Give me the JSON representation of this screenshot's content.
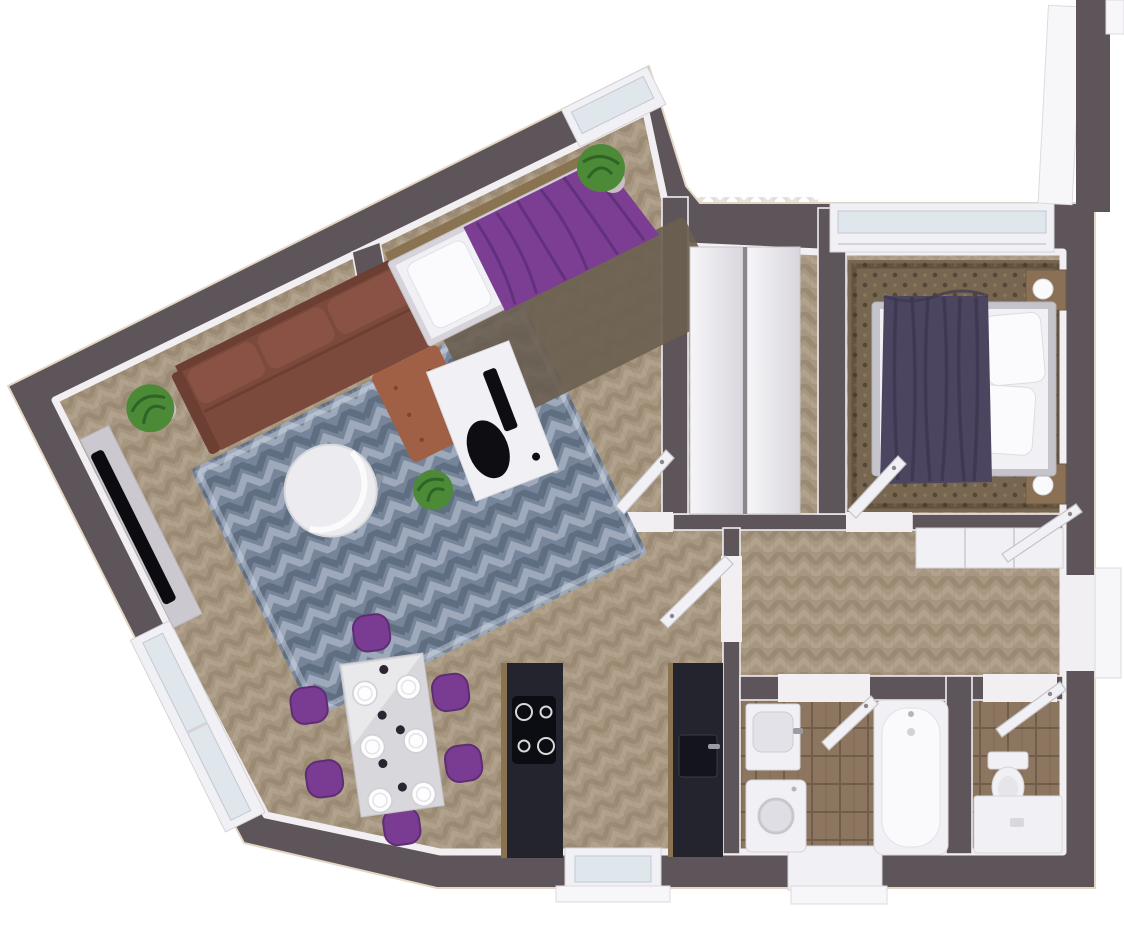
{
  "meta": {
    "title": "3D top-view render of an apartment floor plan",
    "view": "top-down 3D render",
    "visible_text": "none"
  },
  "colors": {
    "background": "#ffffff",
    "wall": "#5e555b",
    "trim": "#f1eff2",
    "wood_floor": "#a89780",
    "tile_floor": "#8d7660",
    "rug_blue": "#76859a",
    "carpet_brown": "#776650",
    "sofa_leather": "#7c4a3d",
    "sofa_chaise": "#a06046",
    "purple_textile": "#7b3e93",
    "master_blanket": "#4c4560",
    "kitchen_counter": "#23242e",
    "counter_wood_edge": "#8a7350",
    "furniture_white": "#f1f0f4",
    "furniture_gray": "#d6d4da",
    "plant_green": "#4c8a38",
    "window_glass": "#dfe6ec",
    "nightstand_wood": "#8a7156"
  },
  "rooms": [
    {
      "name": "living-dining-kitchen",
      "label": "Open living / dining / kitchen (angled wing)",
      "furniture": [
        "corner-sofa-leather",
        "blue-chevron-rug",
        "round-coffee-table",
        "tv-cabinet",
        "wall-tv",
        "dining-table-white",
        "dining-chairs-purple-x6",
        "plates-x6",
        "kitchen-counter-with-cooktop",
        "kitchen-counter-with-sink",
        "potted-plant-x2",
        "balcony-window",
        "apex-window",
        "kitchen-window"
      ]
    },
    {
      "name": "bedroom-second",
      "label": "Second bedroom (angled wing)",
      "furniture": [
        "single-bed-purple-blanket",
        "white-pillow",
        "dark-rug",
        "desk-white",
        "desk-chair-black",
        "potted-plant",
        "open-door"
      ]
    },
    {
      "name": "corridor",
      "label": "Corridor with storage",
      "furniture": [
        "wardrobe-white-double"
      ]
    },
    {
      "name": "bedroom-master",
      "label": "Master bedroom",
      "furniture": [
        "double-bed",
        "purple-throw-blanket",
        "pillows-x2",
        "nightstand-x2",
        "sphere-lamp-x2",
        "patterned-brown-carpet",
        "top-window",
        "open-door"
      ]
    },
    {
      "name": "hallway",
      "label": "Hallway",
      "furniture": [
        "white-console-closet",
        "balcony-doorway-open-door",
        "entrance-threshold"
      ]
    },
    {
      "name": "bathroom",
      "label": "Bathroom",
      "furniture": [
        "bathtub",
        "washing-machine",
        "vanity-sink",
        "wood-tile-floor",
        "open-door",
        "window"
      ]
    },
    {
      "name": "shower-room",
      "label": "Shower room",
      "furniture": [
        "shower-tray",
        "toilet",
        "wood-tile-floor",
        "open-door"
      ]
    }
  ]
}
